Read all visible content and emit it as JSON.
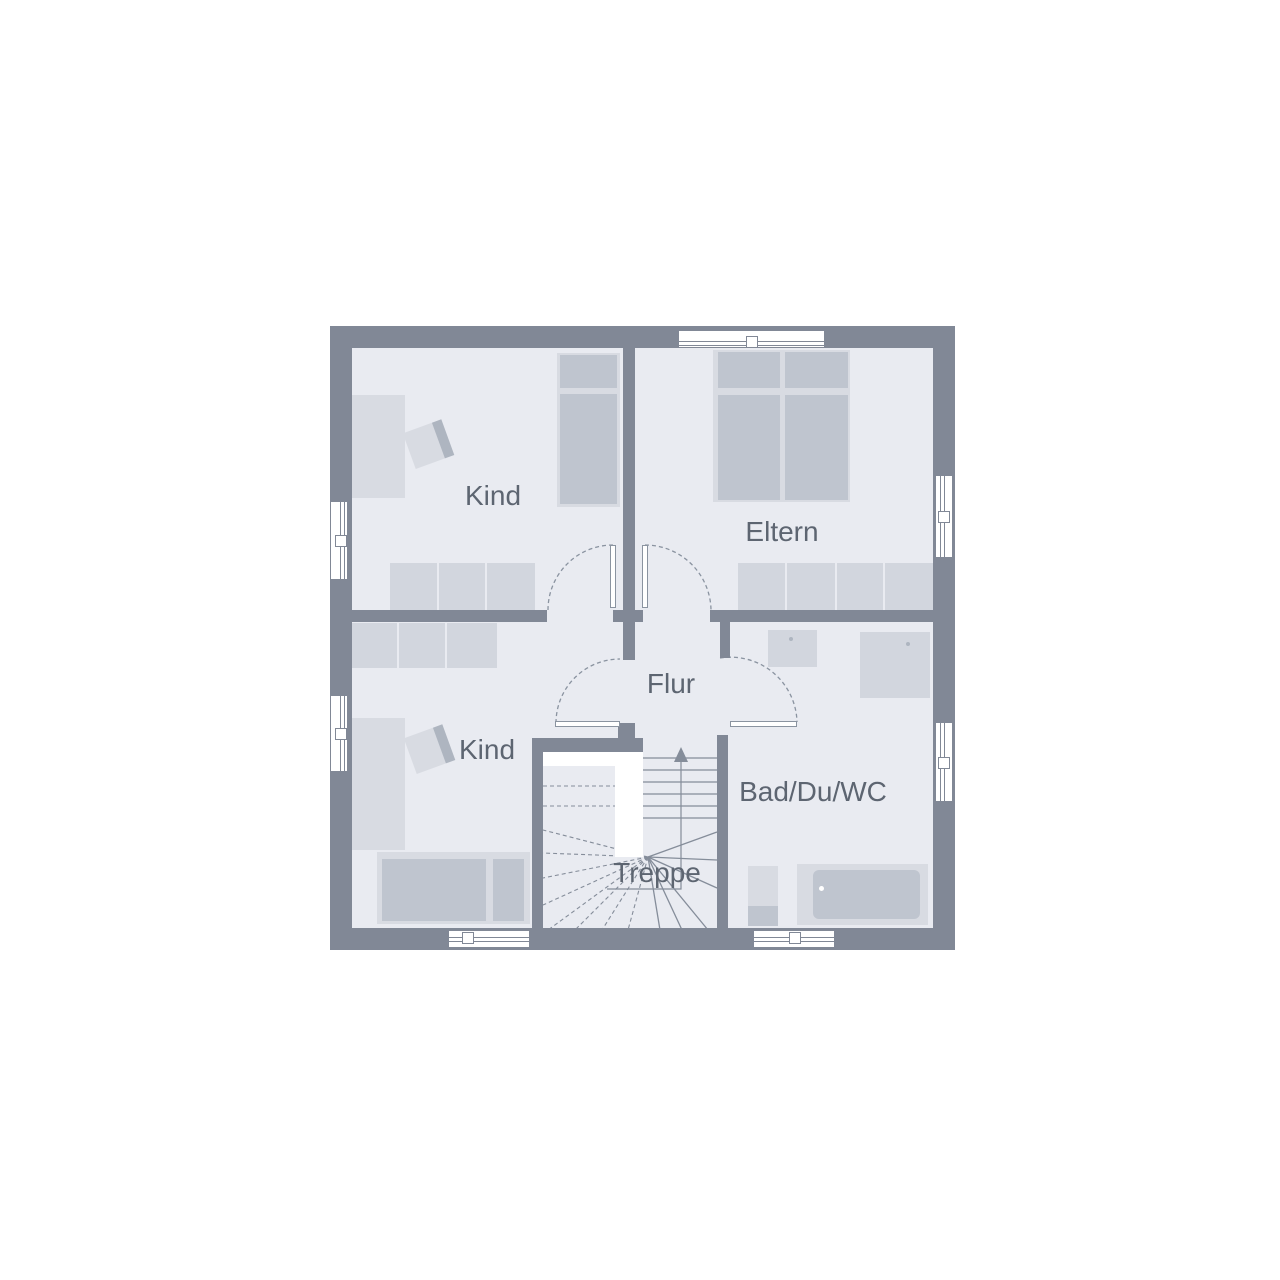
{
  "plan": {
    "type": "floor-plan",
    "rooms": [
      {
        "id": "kind-upper",
        "label": "Kind"
      },
      {
        "id": "eltern",
        "label": "Eltern"
      },
      {
        "id": "kind-lower",
        "label": "Kind"
      },
      {
        "id": "flur",
        "label": "Flur"
      },
      {
        "id": "bad",
        "label": "Bad/Du/WC"
      },
      {
        "id": "treppe",
        "label": "Treppe"
      }
    ],
    "colors": {
      "wall": "#818896",
      "floor": "#e9ebf1",
      "furn": "#d8dbe2",
      "furnDark": "#bfc5cf",
      "wardrobe": "#d2d6de",
      "line": "#858d9a",
      "dash": "#8a93a0",
      "text": "#5d6571",
      "chairBack": "#aeb5c0"
    }
  }
}
